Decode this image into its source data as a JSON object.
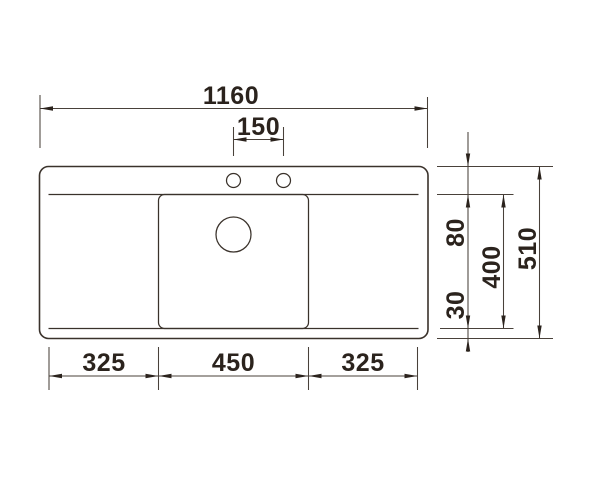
{
  "drawing": {
    "description": "technical dimension drawing, kitchen sink top view",
    "line_color": "#3a322b",
    "text_color": "#2b231d",
    "background_color": "#ffffff"
  },
  "dims": {
    "overall_width": "1160",
    "tap_hole_spacing": "150",
    "left_drainer_width": "325",
    "bowl_width": "450",
    "right_drainer_width": "325",
    "rim_to_bowl": "80",
    "bowl_length": "400",
    "bowl_to_rim": "30",
    "overall_depth": "510"
  }
}
